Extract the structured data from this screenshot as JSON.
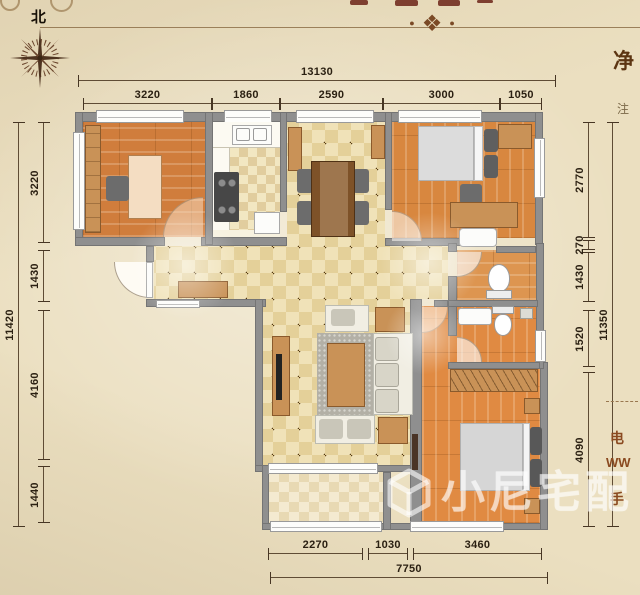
{
  "compass": {
    "north_label": "北"
  },
  "dimensions": {
    "top_total": "13130",
    "top_segments": [
      "3220",
      "1860",
      "2590",
      "3000",
      "1050"
    ],
    "left_total": "11420",
    "left_segments": [
      "3220",
      "1430",
      "4160",
      "1440"
    ],
    "right_total": "11350",
    "right_segments": [
      "2770",
      "270",
      "1430",
      "1520",
      "4090"
    ],
    "bottom_total": "7750",
    "bottom_segments": [
      "2270",
      "1030",
      "3460"
    ]
  },
  "edge_text": {
    "net": "净",
    "note": "注",
    "phone": "电",
    "web": "WW",
    "mobile": "手"
  },
  "watermark": {
    "brand": "小尼宅配"
  },
  "colors": {
    "wall": "#8f8f8f",
    "wood_floor": "#d8873f",
    "tile": "#f0e2b8",
    "dimension_text": "#2b2012",
    "accent_brown": "#7b4a26",
    "watermark_white": "rgba(255,255,255,0.55)"
  }
}
